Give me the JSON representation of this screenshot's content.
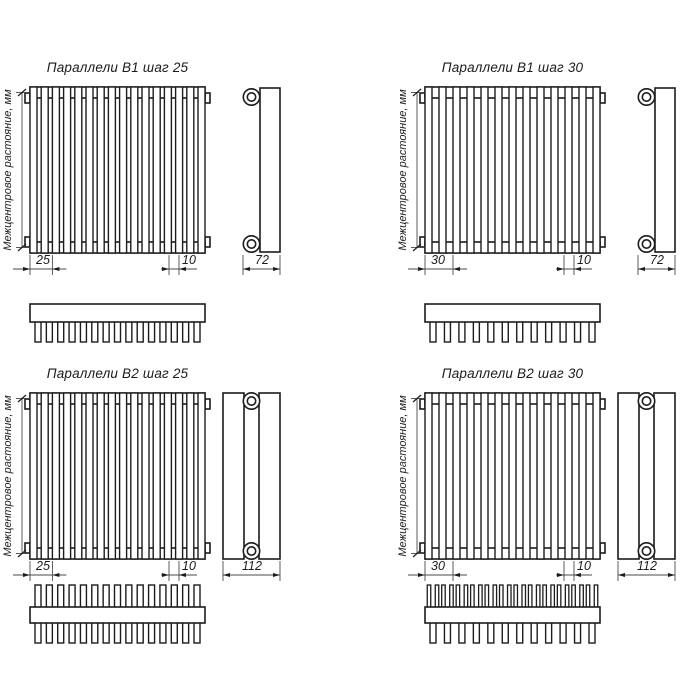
{
  "sheet": {
    "background": "#ffffff",
    "line_color": "#1c1c1c",
    "thin_line_color": "#4a4a4a"
  },
  "axis_label": "Межцентровое растояние, мм",
  "quadrants": [
    {
      "id": "b1-step-25",
      "title": "Параллели В1 шаг 25",
      "step_dim": "25",
      "tube_dim": "10",
      "depth_dim": "72",
      "rows": 1,
      "front_tubes": 16,
      "teeth_bottom": 15,
      "teeth_top": 0
    },
    {
      "id": "b1-step-30",
      "title": "Параллели В1 шаг 30",
      "step_dim": "30",
      "tube_dim": "10",
      "depth_dim": "72",
      "rows": 1,
      "front_tubes": 13,
      "teeth_bottom": 12,
      "teeth_top": 0
    },
    {
      "id": "b2-step-25",
      "title": "Параллели В2 шаг 25",
      "step_dim": "25",
      "tube_dim": "10",
      "depth_dim": "112",
      "rows": 2,
      "front_tubes": 16,
      "teeth_bottom": 15,
      "teeth_top": 15
    },
    {
      "id": "b2-step-30",
      "title": "Параллели В2 шаг 30",
      "step_dim": "30",
      "tube_dim": "10",
      "depth_dim": "112",
      "rows": 2,
      "front_tubes": 13,
      "teeth_bottom": 12,
      "teeth_top": 24
    }
  ]
}
